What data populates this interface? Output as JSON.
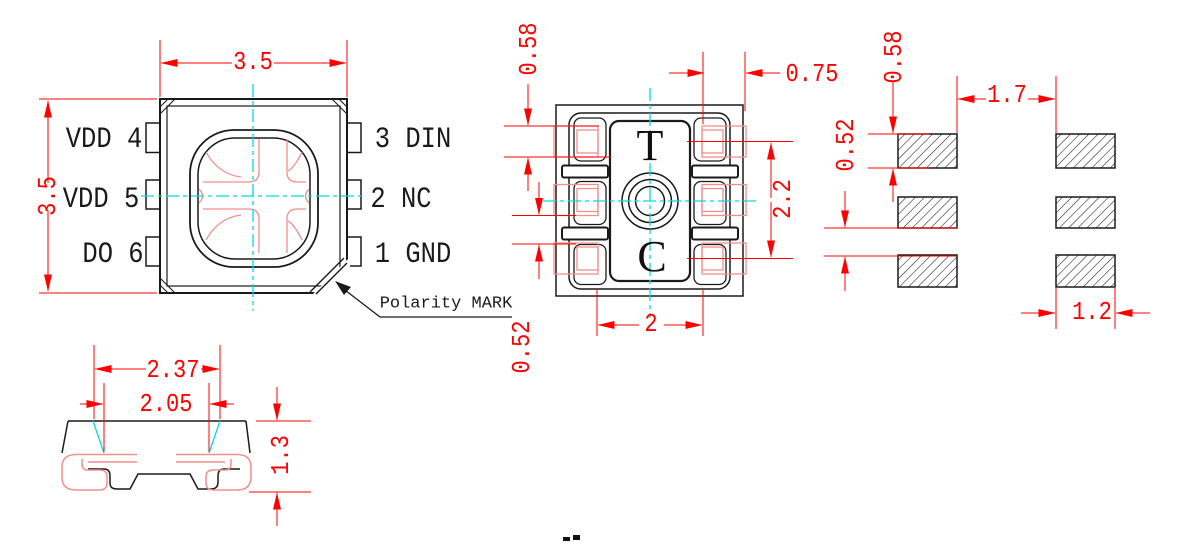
{
  "top_view": {
    "pins_left": [
      {
        "label": "VDD 4"
      },
      {
        "label": "VDD 5"
      },
      {
        "label": "DO 6"
      }
    ],
    "pins_right": [
      {
        "label": "3 DIN"
      },
      {
        "label": "2 NC"
      },
      {
        "label": "1 GND"
      }
    ],
    "dim_width": "3.5",
    "dim_height": "3.5",
    "polarity_label": "Polarity MARK"
  },
  "bottom_view": {
    "mark_top": "T",
    "mark_bottom": "C",
    "dim_pad_height": "0.58",
    "dim_pad_width": "0.75",
    "dim_pad_gap": "0.52",
    "dim_rows_span": "2.2",
    "dim_inner_span": "2"
  },
  "pad_layout": {
    "dim_pad_height": "0.58",
    "dim_row_gap": "0.52",
    "dim_col_gap": "1.7",
    "dim_pad_width": "1.2"
  },
  "side_view": {
    "dim_top_width": "2.37",
    "dim_lead_width": "2.05",
    "dim_height": "1.3"
  },
  "colors": {
    "dimension_red": "#ff0000",
    "overlay_pink": "#f08f8d",
    "centerline_cyan": "#00dce8",
    "line_black": "#1a1a1a"
  }
}
